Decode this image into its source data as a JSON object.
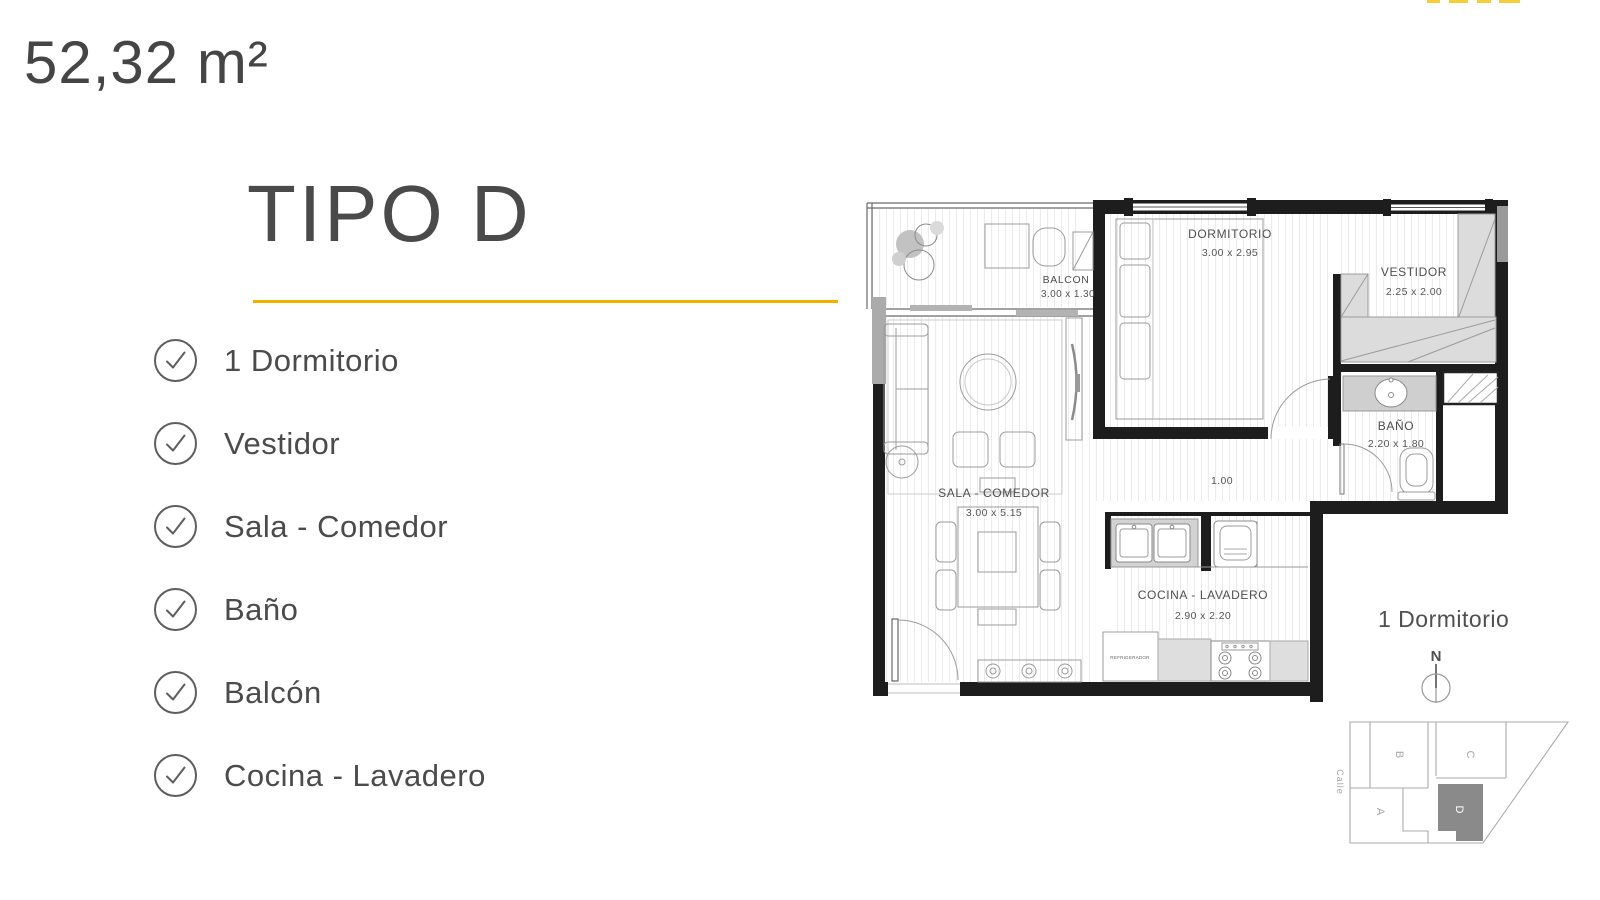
{
  "header": {
    "area_label": "52,32 m²",
    "title": "TIPO D"
  },
  "features": {
    "items": [
      "1 Dormitorio",
      "Vestidor",
      "Sala - Comedor",
      "Baño",
      "Balcón",
      "Cocina - Lavadero"
    ]
  },
  "plan": {
    "rooms": {
      "balcon": {
        "name": "BALCON",
        "dims": "3.00 x 1.30"
      },
      "dormitorio": {
        "name": "DORMITORIO",
        "dims": "3.00 x 2.95"
      },
      "vestidor": {
        "name": "VESTIDOR",
        "dims": "2.25 x 2.00"
      },
      "bano": {
        "name": "BAÑO",
        "dims": "2.20 x 1.80"
      },
      "sala": {
        "name": "SALA - COMEDOR",
        "dims": "3.00 x 5.15"
      },
      "cocina": {
        "name": "COCINA - LAVADERO",
        "dims": "2.90 x 2.20"
      }
    },
    "hall_width": "1.00",
    "fridge_label": "REFRIGERADOR"
  },
  "legend": {
    "unit_type": "1 Dormitorio",
    "north": "N"
  },
  "site_map": {
    "street": "Calle",
    "units": {
      "b": "B",
      "c": "C",
      "a": "A",
      "d": "D"
    },
    "highlighted_unit": "D"
  },
  "colors": {
    "accent": "#F2AF00",
    "site_dark": "#8A8A8A"
  }
}
